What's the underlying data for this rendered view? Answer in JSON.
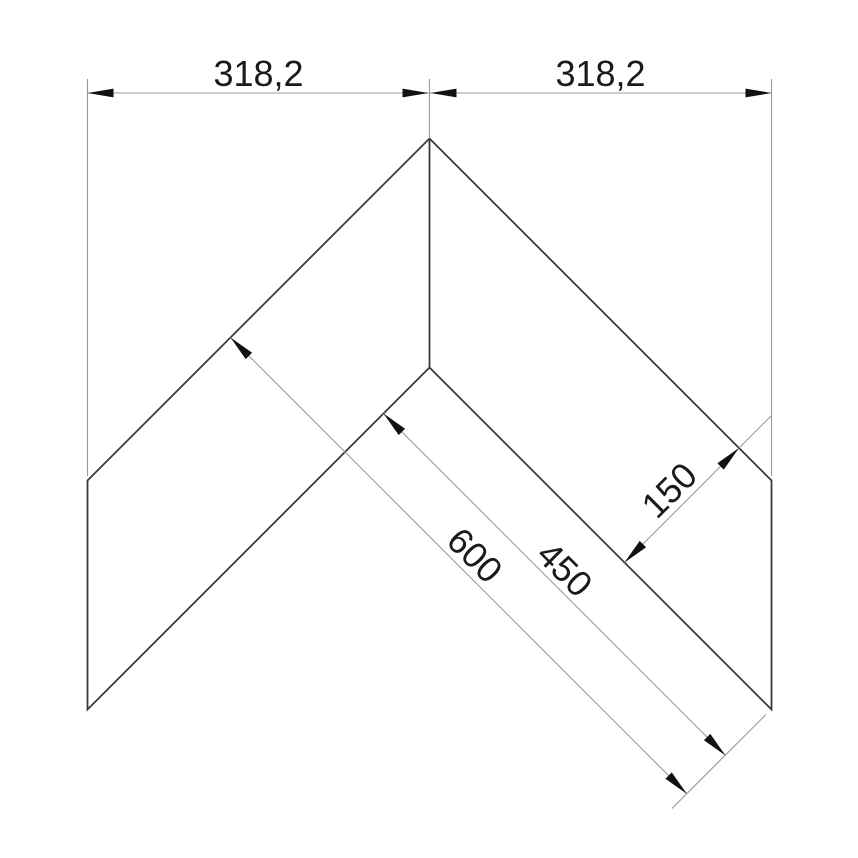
{
  "page": {
    "background": "#ffffff",
    "description": "CAD technical drawing: mitered V-shaped (chevron) corner profile with linear dimensions",
    "units_implied": "mm"
  },
  "drawing": {
    "type": "dimensioned-outline",
    "part": {
      "name": "chevron-corner-profile",
      "outline_vertices_px": [
        [
          429.5,
          138.5
        ],
        [
          87.5,
          480.5
        ],
        [
          87.5,
          709.5
        ],
        [
          429.5,
          367.5
        ],
        [
          771.5,
          709.5
        ],
        [
          771.5,
          480.5
        ]
      ],
      "miter_line_px": [
        [
          429.5,
          138.5
        ],
        [
          429.5,
          367.5
        ]
      ]
    },
    "dimensions": [
      {
        "id": "dim-top-left",
        "label": "318,2",
        "value": 318.2,
        "orientation": "horizontal",
        "measures": "horizontal span of left wing (apex to left end)"
      },
      {
        "id": "dim-top-right",
        "label": "318,2",
        "value": 318.2,
        "orientation": "horizontal",
        "measures": "horizontal span of right wing (apex to right end)"
      },
      {
        "id": "dim-600",
        "label": "600",
        "value": 600,
        "orientation": "diagonal-45",
        "measures": "overall length from outer left edge to right end"
      },
      {
        "id": "dim-450",
        "label": "450",
        "value": 450,
        "orientation": "diagonal-45",
        "measures": "inner edge length from inner corner to right end"
      },
      {
        "id": "dim-150",
        "label": "150",
        "value": 150,
        "orientation": "diagonal-perpendicular",
        "measures": "perpendicular wing width"
      }
    ],
    "colors": {
      "part_edge": "#3a3a3a",
      "dimension_line": "#999999",
      "arrow": "#111111",
      "text": "#1a1a1a",
      "background": "#ffffff"
    }
  }
}
